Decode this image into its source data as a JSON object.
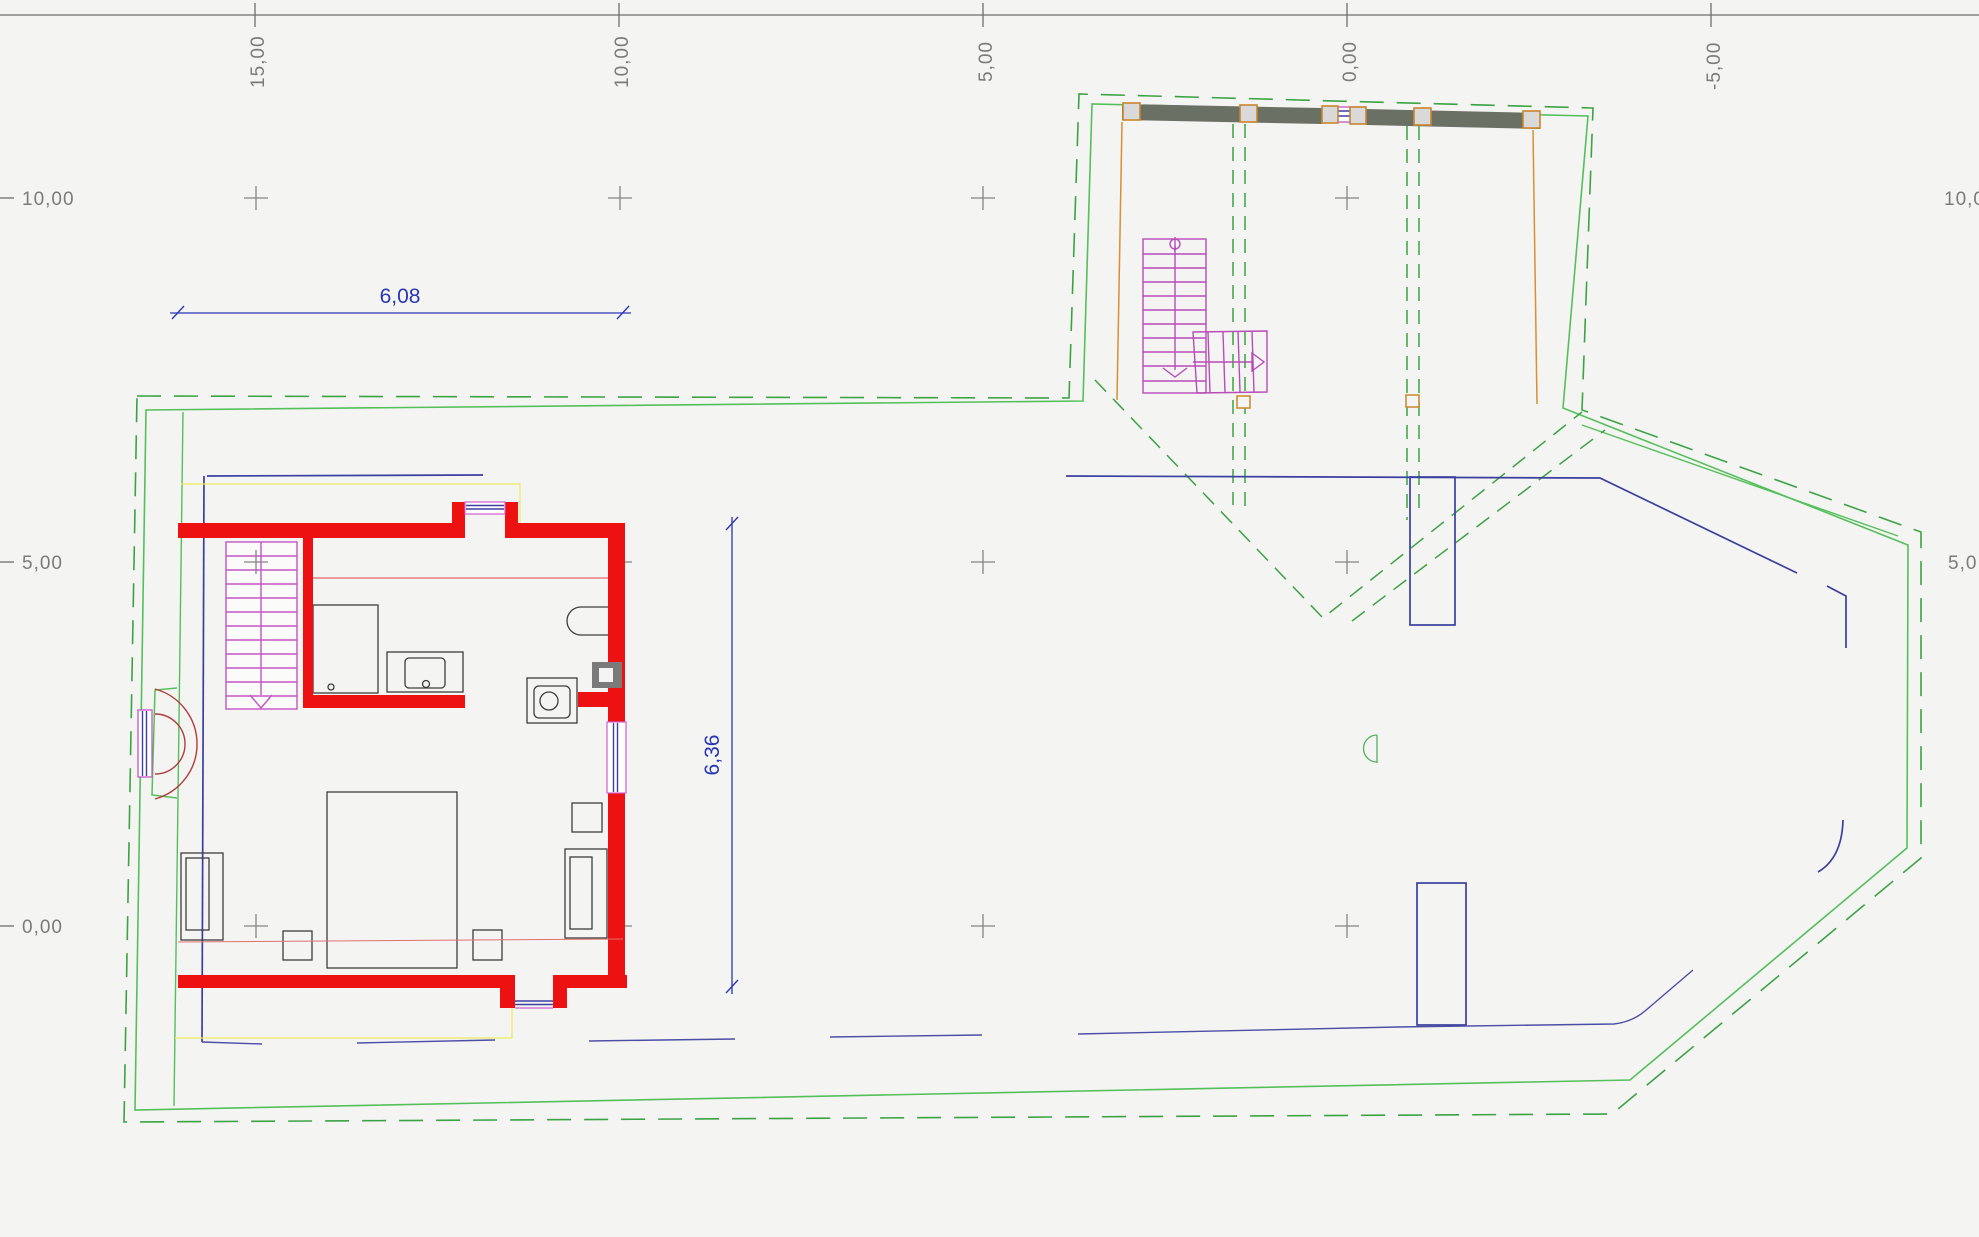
{
  "drawing": {
    "type": "cad-floor-plan",
    "axis_labels": {
      "top": [
        "15,00",
        "10,00",
        "5,00",
        "0,00",
        "-5,00"
      ],
      "left": [
        "10,00",
        "5,00",
        "0,00"
      ],
      "right": [
        "10,0",
        "5,0"
      ]
    },
    "dimension_labels": {
      "horizontal": "6,08",
      "vertical": "6,36"
    },
    "grid_spacing_meters": "5,00"
  },
  "colors": {
    "background": "#f4f4f2",
    "axis_gray": "#7b7b7b",
    "wall_red": "#ee1111",
    "section_red_thin": "#e04545",
    "door_arc_red": "#b23c3c",
    "boundary_green_solid": "#55c05b",
    "boundary_green_dashed": "#3ca344",
    "stair_magenta": "#c455c4",
    "dimension_blue": "#2936b5",
    "outline_navy": "#3b3f9f",
    "terrain_slate": "#4d4da6",
    "post_orange": "#c8862e",
    "garage_bar_gray": "#6b7064",
    "chimney_gray": "#7a7a7a",
    "lower_floor_yellow": "#e9e95c",
    "furniture_gray": "#3d3d3d"
  }
}
